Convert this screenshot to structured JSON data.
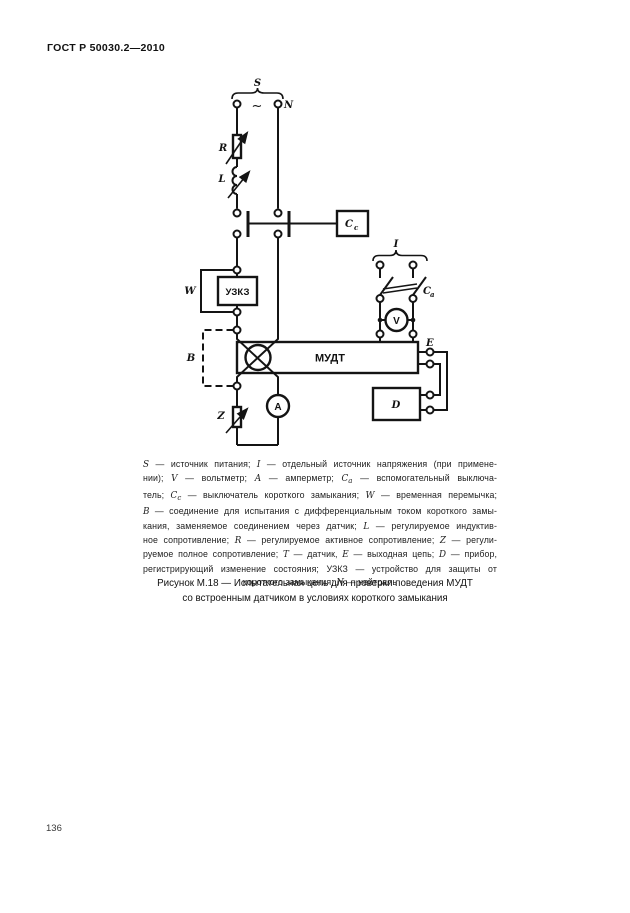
{
  "page": {
    "header": "ГОСТ Р 50030.2—2010",
    "page_number": "136"
  },
  "diagram": {
    "labels": {
      "source_brace": "S",
      "ac_symbol": "~",
      "neutral": "N",
      "resistor": "R",
      "inductor": "L",
      "sc_switch_main": "C",
      "sc_switch_sub": "с",
      "uzkz": "УЗКЗ",
      "jumper": "W",
      "bracket_b": "B",
      "mudt": "МУДТ",
      "impedance": "Z",
      "ammeter": "A",
      "voltmeter": "V",
      "current_source": "I",
      "aux_switch_main": "C",
      "aux_switch_sub": "а",
      "output": "E",
      "device": "D"
    }
  },
  "legend": {
    "lines": [
      [
        {
          "t": "S",
          "i": 1
        },
        {
          "t": " — источник питания; "
        },
        {
          "t": "I",
          "i": 1
        },
        {
          "t": " — отдельный источник напряжения (при примене-"
        }
      ],
      [
        {
          "t": "нии); "
        },
        {
          "t": "V",
          "i": 1
        },
        {
          "t": " — вольтметр; "
        },
        {
          "t": "А",
          "i": 1
        },
        {
          "t": " — амперметр; "
        },
        {
          "t": "С",
          "i": 1
        },
        {
          "t": "а",
          "i": 1,
          "sub": 1
        },
        {
          "t": " — вспомогательный выключа-"
        }
      ],
      [
        {
          "t": "тель; "
        },
        {
          "t": "С",
          "i": 1
        },
        {
          "t": "с",
          "i": 1,
          "sub": 1
        },
        {
          "t": " — выключатель короткого замыкания; "
        },
        {
          "t": "W",
          "i": 1
        },
        {
          "t": " — временная перемычка;"
        }
      ],
      [
        {
          "t": "В",
          "i": 1
        },
        {
          "t": " — соединение для испытания с дифференциальным током короткого замы-"
        }
      ],
      [
        {
          "t": "кания, заменяемое соединением через датчик; "
        },
        {
          "t": "L",
          "i": 1
        },
        {
          "t": " — регулируемое индуктив-"
        }
      ],
      [
        {
          "t": "ное сопротивление; "
        },
        {
          "t": "R",
          "i": 1
        },
        {
          "t": " — регулируемое активное сопротивление; "
        },
        {
          "t": "Z",
          "i": 1
        },
        {
          "t": " — регули-"
        }
      ],
      [
        {
          "t": "руемое полное сопротивление; "
        },
        {
          "t": "Т",
          "i": 1
        },
        {
          "t": " — датчик, "
        },
        {
          "t": "Е",
          "i": 1
        },
        {
          "t": " — выходная цепь; "
        },
        {
          "t": "D",
          "i": 1
        },
        {
          "t": " — прибор,"
        }
      ],
      [
        {
          "t": "регистрирующий изменение состояния; УЗКЗ — устройство для защиты от"
        }
      ],
      [
        {
          "t": "короткого замыкания; "
        },
        {
          "t": "N",
          "i": 1
        },
        {
          "t": " — нейтраль"
        }
      ]
    ]
  },
  "caption": {
    "line1": "Рисунок М.18 — Испытательная цепь для проверки поведения МУДТ",
    "line2": "со встроенным датчиком в условиях короткого замыкания"
  }
}
